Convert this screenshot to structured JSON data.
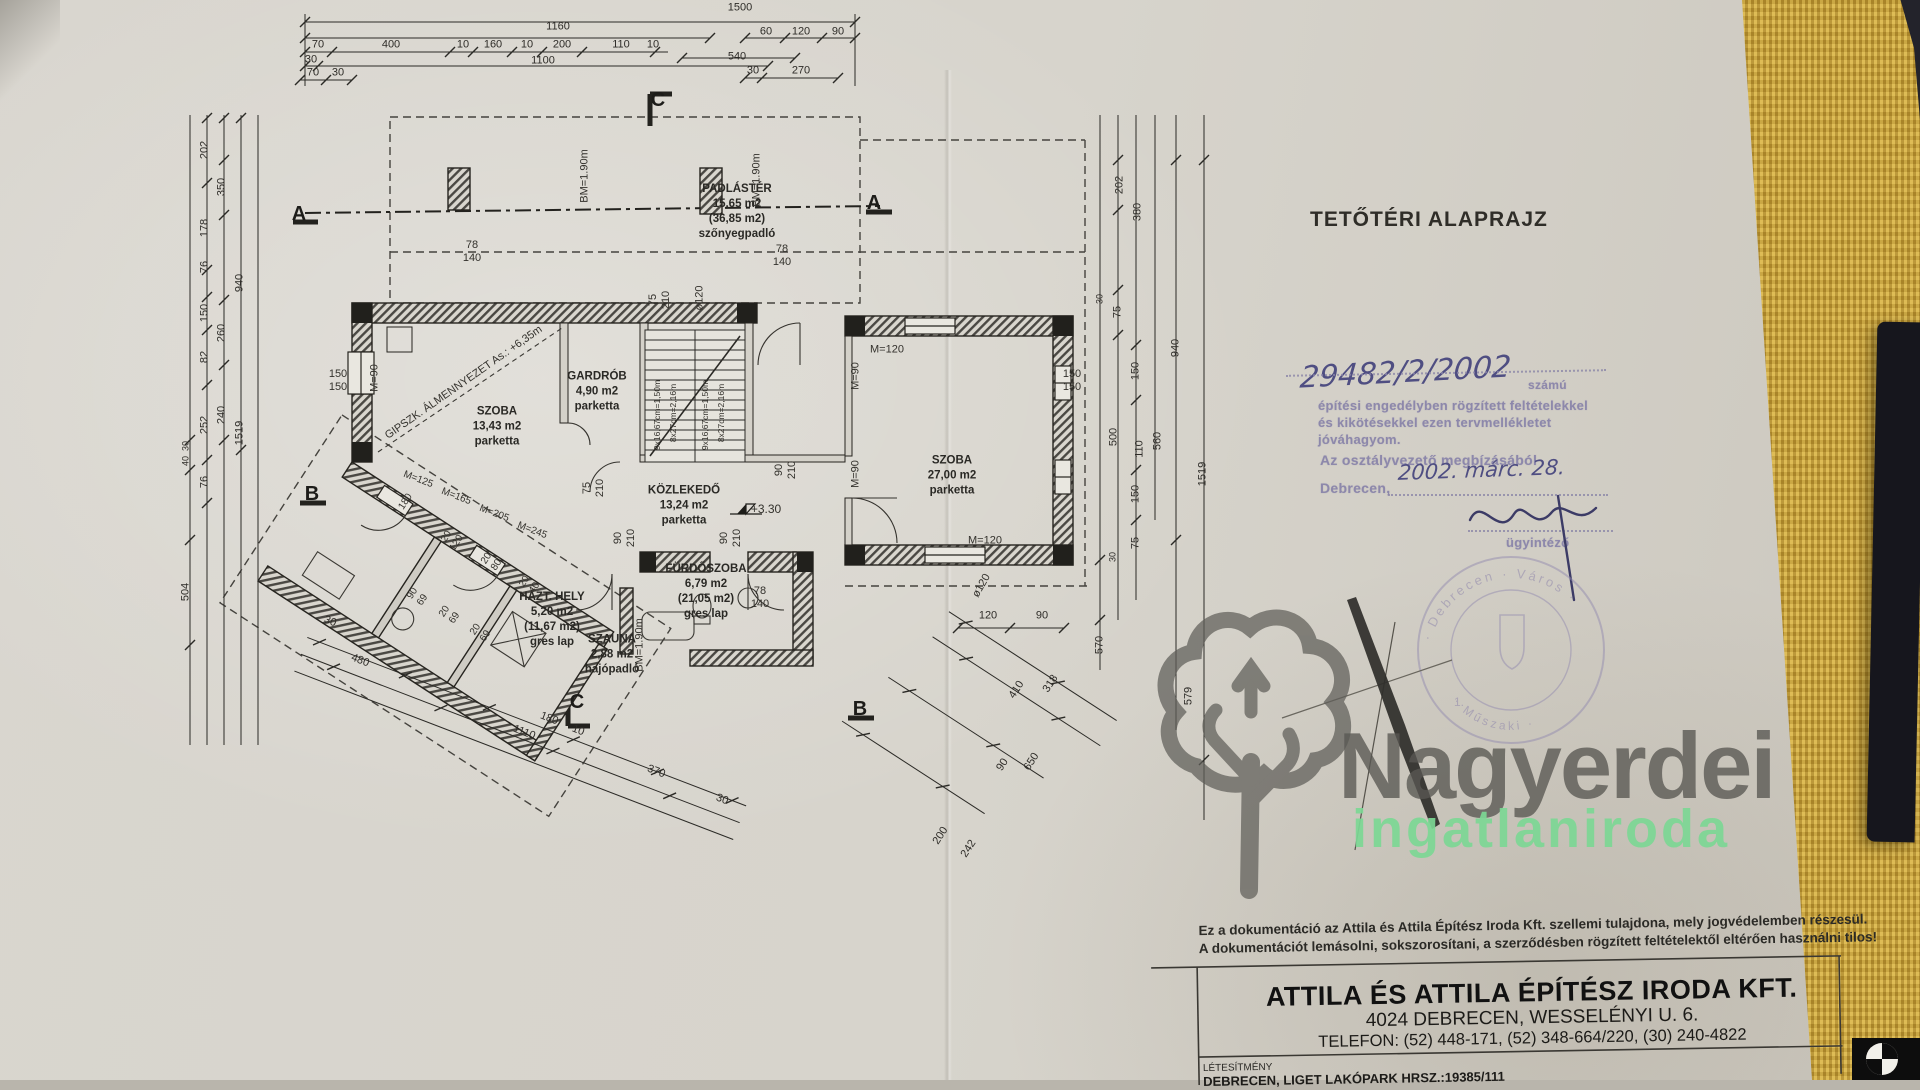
{
  "colors": {
    "paper": "#D7D4CC",
    "fabric": "#C9A33C",
    "ink": "#2B2A26",
    "stamp_purple": "#8D88AB",
    "hand_ink": "#4F4E82",
    "wm_gray": "#585752",
    "wm_green": "#7CD794"
  },
  "meta": {
    "title": "TETŐTÉRI ALAPRAJZ"
  },
  "approval": {
    "number": "29482/2/2002",
    "number_suffix": "számú",
    "line1": "építési engedélyben rögzített feltételekkel",
    "line2": "és kikötésekkel ezen tervmellékletet",
    "line3": "jóváhagyom.",
    "line4": "Az osztályvezető megbízásából",
    "city": "Debrecen,",
    "date": "2002. márc. 28.",
    "role": "ügyintéző"
  },
  "round_stamp": {
    "arc_top": "· Debrecen · Város ·",
    "arc_bottom": "· Műszaki ·",
    "center": "1."
  },
  "watermark": {
    "name": "Nagyerdei",
    "tagline": "ingatlaniroda"
  },
  "footer": {
    "copyright1": "Ez a dokumentáció az Attila és Attila Építész Iroda Kft. szellemi tulajdona, mely jogvédelemben részesül.",
    "copyright2": "A dokumentációt lemásolni, sokszorosítani, a szerződésben rögzített feltételektől eltérően használni tilos!",
    "company": "ATTILA ÉS ATTILA ÉPÍTÉSZ IRODA KFT.",
    "address": "4024 DEBRECEN, WESSELÉNYI U. 6.",
    "phone": "TELEFON: (52) 448-171, (52) 348-664/220, (30) 240-4822",
    "facility_label": "LÉTESÍTMÉNY",
    "facility": "DEBRECEN, LIGET LAKÓPARK  HRSZ.:19385/111"
  },
  "rooms": [
    {
      "text": "PADLÁSTÉR\n15,65 m2\n(36,85 m2)\nszőnyegpadló",
      "x": 737,
      "y": 212
    },
    {
      "text": "SZOBA\n13,43 m2\nparketta",
      "x": 497,
      "y": 427
    },
    {
      "text": "GARDRÓB\n4,90 m2\nparketta",
      "x": 597,
      "y": 392
    },
    {
      "text": "KÖZLEKEDŐ\n13,24 m2\nparketta",
      "x": 684,
      "y": 506
    },
    {
      "text": "SZOBA\n27,00 m2\nparketta",
      "x": 952,
      "y": 476
    },
    {
      "text": "HÁZT. HELY\n5,20 m2\n(11,67 m2)\ngres lap",
      "x": 552,
      "y": 620
    },
    {
      "text": "FÜRDŐSZOBA\n6,79 m2\n(21,05 m2)\ngres lap",
      "x": 706,
      "y": 592
    },
    {
      "text": "SZAUNA\n2,88 m2\nhajópadló",
      "x": 612,
      "y": 655
    }
  ],
  "plan_labels": [
    {
      "text": "GIPSZK. ÁLMENNYEZET As.: +6,35m",
      "x": 464,
      "y": 383,
      "rot": -35,
      "fs": 11
    },
    {
      "text": "78\n140",
      "x": 472,
      "y": 252
    },
    {
      "text": "78\n140",
      "x": 782,
      "y": 256
    },
    {
      "text": "78\n140",
      "x": 760,
      "y": 598
    },
    {
      "text": "BM=1.90m",
      "x": 585,
      "y": 176,
      "rot": -90
    },
    {
      "text": "BM=1.90m",
      "x": 757,
      "y": 180,
      "rot": -90
    },
    {
      "text": "BM=1.90m",
      "x": 640,
      "y": 645,
      "rot": -90
    },
    {
      "text": "M=90",
      "x": 375,
      "y": 378,
      "rot": -90
    },
    {
      "text": "M=90",
      "x": 856,
      "y": 376,
      "rot": -90
    },
    {
      "text": "M=90",
      "x": 856,
      "y": 474,
      "rot": -90
    },
    {
      "text": "M=120",
      "x": 887,
      "y": 350
    },
    {
      "text": "M=120",
      "x": 985,
      "y": 541
    },
    {
      "text": "ø120",
      "x": 700,
      "y": 298,
      "rot": -90
    },
    {
      "text": "ø120",
      "x": 982,
      "y": 586,
      "rot": -60
    },
    {
      "text": "150\n150",
      "x": 338,
      "y": 381
    },
    {
      "text": "150\n150",
      "x": 1072,
      "y": 381
    },
    {
      "text": "75\n210",
      "x": 594,
      "y": 488,
      "rot": -90
    },
    {
      "text": "90\n210",
      "x": 786,
      "y": 470,
      "rot": -90
    },
    {
      "text": "90\n210",
      "x": 625,
      "y": 538,
      "rot": -90
    },
    {
      "text": "90\n210",
      "x": 731,
      "y": 538,
      "rot": -90
    },
    {
      "text": "75\n210",
      "x": 660,
      "y": 300,
      "rot": -90
    },
    {
      "text": "9x16,67cm=1,50m",
      "x": 657,
      "y": 415,
      "rot": -90,
      "fs": 8.5
    },
    {
      "text": "8x27cm=2,16m",
      "x": 673,
      "y": 413,
      "rot": -90,
      "fs": 8.5
    },
    {
      "text": "9x16,67cm=1,50m",
      "x": 705,
      "y": 415,
      "rot": -90,
      "fs": 8.5
    },
    {
      "text": "8x27cm=2,16m",
      "x": 721,
      "y": 413,
      "rot": -90,
      "fs": 8.5
    },
    {
      "text": "M=125",
      "x": 418,
      "y": 480,
      "rot": 21,
      "fs": 10
    },
    {
      "text": "M=165",
      "x": 456,
      "y": 497,
      "rot": 21,
      "fs": 10
    },
    {
      "text": "M=205",
      "x": 494,
      "y": 514,
      "rot": 21,
      "fs": 10
    },
    {
      "text": "M=245",
      "x": 532,
      "y": 531,
      "rot": 21,
      "fs": 10
    },
    {
      "text": "+3.30",
      "x": 766,
      "y": 509,
      "fs": 12
    },
    {
      "text": "180",
      "x": 406,
      "y": 502,
      "rot": -57,
      "fs": 10
    },
    {
      "text": "20\n120",
      "x": 452,
      "y": 540,
      "rot": -57,
      "fs": 10
    },
    {
      "text": "20\n80",
      "x": 492,
      "y": 562,
      "rot": -57,
      "fs": 10
    },
    {
      "text": "20\n40",
      "x": 530,
      "y": 585,
      "rot": -57,
      "fs": 10
    },
    {
      "text": "90\n69",
      "x": 418,
      "y": 597,
      "rot": -57,
      "fs": 10
    },
    {
      "text": "20\n69",
      "x": 450,
      "y": 615,
      "rot": -57,
      "fs": 10
    },
    {
      "text": "20\n69",
      "x": 481,
      "y": 633,
      "rot": -57,
      "fs": 10
    }
  ],
  "section_markers": [
    {
      "text": "A",
      "x": 299,
      "y": 214
    },
    {
      "text": "A",
      "x": 874,
      "y": 203
    },
    {
      "text": "B",
      "x": 312,
      "y": 494
    },
    {
      "text": "B",
      "x": 860,
      "y": 709
    },
    {
      "text": "C",
      "x": 658,
      "y": 100
    },
    {
      "text": "C",
      "x": 577,
      "y": 702
    }
  ],
  "dims_top": [
    {
      "text": "1500",
      "x": 740,
      "y": 8
    },
    {
      "text": "1160",
      "x": 558,
      "y": 27
    },
    {
      "text": "60",
      "x": 766,
      "y": 32
    },
    {
      "text": "120",
      "x": 801,
      "y": 32
    },
    {
      "text": "90",
      "x": 838,
      "y": 32
    },
    {
      "text": "70",
      "x": 318,
      "y": 45
    },
    {
      "text": "400",
      "x": 391,
      "y": 45
    },
    {
      "text": "10",
      "x": 463,
      "y": 45
    },
    {
      "text": "160",
      "x": 493,
      "y": 45
    },
    {
      "text": "10",
      "x": 527,
      "y": 45
    },
    {
      "text": "200",
      "x": 562,
      "y": 45
    },
    {
      "text": "110",
      "x": 621,
      "y": 45
    },
    {
      "text": "10",
      "x": 653,
      "y": 45
    },
    {
      "text": "540",
      "x": 737,
      "y": 57
    },
    {
      "text": "30",
      "x": 311,
      "y": 60
    },
    {
      "text": "1100",
      "x": 543,
      "y": 61
    },
    {
      "text": "30",
      "x": 753,
      "y": 71
    },
    {
      "text": "270",
      "x": 801,
      "y": 71
    },
    {
      "text": "70",
      "x": 313,
      "y": 73
    },
    {
      "text": "30",
      "x": 338,
      "y": 73
    }
  ],
  "dims_left": [
    {
      "text": "202",
      "x": 205,
      "y": 150,
      "rot": -90
    },
    {
      "text": "350",
      "x": 222,
      "y": 187,
      "rot": -90
    },
    {
      "text": "178",
      "x": 205,
      "y": 228,
      "rot": -90
    },
    {
      "text": "76",
      "x": 205,
      "y": 267,
      "rot": -90
    },
    {
      "text": "940",
      "x": 240,
      "y": 283,
      "rot": -90
    },
    {
      "text": "150",
      "x": 205,
      "y": 313,
      "rot": -90
    },
    {
      "text": "260",
      "x": 222,
      "y": 333,
      "rot": -90
    },
    {
      "text": "82",
      "x": 205,
      "y": 357,
      "rot": -90
    },
    {
      "text": "240",
      "x": 222,
      "y": 415,
      "rot": -90
    },
    {
      "text": "252",
      "x": 205,
      "y": 425,
      "rot": -90
    },
    {
      "text": "1519",
      "x": 240,
      "y": 433,
      "rot": -90
    },
    {
      "text": "30",
      "x": 186,
      "y": 446,
      "rot": -90,
      "fs": 9
    },
    {
      "text": "40",
      "x": 186,
      "y": 461,
      "rot": -90,
      "fs": 9
    },
    {
      "text": "76",
      "x": 205,
      "y": 482,
      "rot": -90
    },
    {
      "text": "504",
      "x": 186,
      "y": 592,
      "rot": -90
    }
  ],
  "dims_right": [
    {
      "text": "202",
      "x": 1120,
      "y": 185,
      "rot": -90
    },
    {
      "text": "380",
      "x": 1138,
      "y": 212,
      "rot": -90
    },
    {
      "text": "30",
      "x": 1100,
      "y": 299,
      "rot": -90,
      "fs": 9
    },
    {
      "text": "75",
      "x": 1118,
      "y": 312,
      "rot": -90
    },
    {
      "text": "940",
      "x": 1176,
      "y": 348,
      "rot": -90
    },
    {
      "text": "150",
      "x": 1136,
      "y": 371,
      "rot": -90
    },
    {
      "text": "500",
      "x": 1114,
      "y": 437,
      "rot": -90
    },
    {
      "text": "110",
      "x": 1140,
      "y": 449,
      "rot": -90
    },
    {
      "text": "560",
      "x": 1158,
      "y": 441,
      "rot": -90
    },
    {
      "text": "150",
      "x": 1136,
      "y": 494,
      "rot": -90
    },
    {
      "text": "1519",
      "x": 1203,
      "y": 474,
      "rot": -90
    },
    {
      "text": "75",
      "x": 1136,
      "y": 543,
      "rot": -90
    },
    {
      "text": "30",
      "x": 1113,
      "y": 557,
      "rot": -90,
      "fs": 9
    },
    {
      "text": "570",
      "x": 1100,
      "y": 645,
      "rot": -90
    },
    {
      "text": "579",
      "x": 1189,
      "y": 696,
      "rot": -90
    }
  ],
  "dims_bottom": [
    {
      "text": "30",
      "x": 330,
      "y": 622,
      "rot": 21
    },
    {
      "text": "480",
      "x": 360,
      "y": 661,
      "rot": 21
    },
    {
      "text": "1110",
      "x": 524,
      "y": 733,
      "rot": 21
    },
    {
      "text": "180",
      "x": 549,
      "y": 719,
      "rot": 21
    },
    {
      "text": "10",
      "x": 578,
      "y": 731,
      "rot": 21
    },
    {
      "text": "370",
      "x": 656,
      "y": 772,
      "rot": 21
    },
    {
      "text": "30",
      "x": 722,
      "y": 800,
      "rot": 21
    },
    {
      "text": "120",
      "x": 988,
      "y": 616
    },
    {
      "text": "90",
      "x": 1042,
      "y": 616
    },
    {
      "text": "410",
      "x": 1017,
      "y": 690,
      "rot": -57
    },
    {
      "text": "318",
      "x": 1051,
      "y": 684,
      "rot": -57
    },
    {
      "text": "90",
      "x": 1003,
      "y": 765,
      "rot": -57
    },
    {
      "text": "650",
      "x": 1032,
      "y": 762,
      "rot": -57
    },
    {
      "text": "200",
      "x": 941,
      "y": 836,
      "rot": -57
    },
    {
      "text": "242",
      "x": 969,
      "y": 849,
      "rot": -57
    }
  ]
}
